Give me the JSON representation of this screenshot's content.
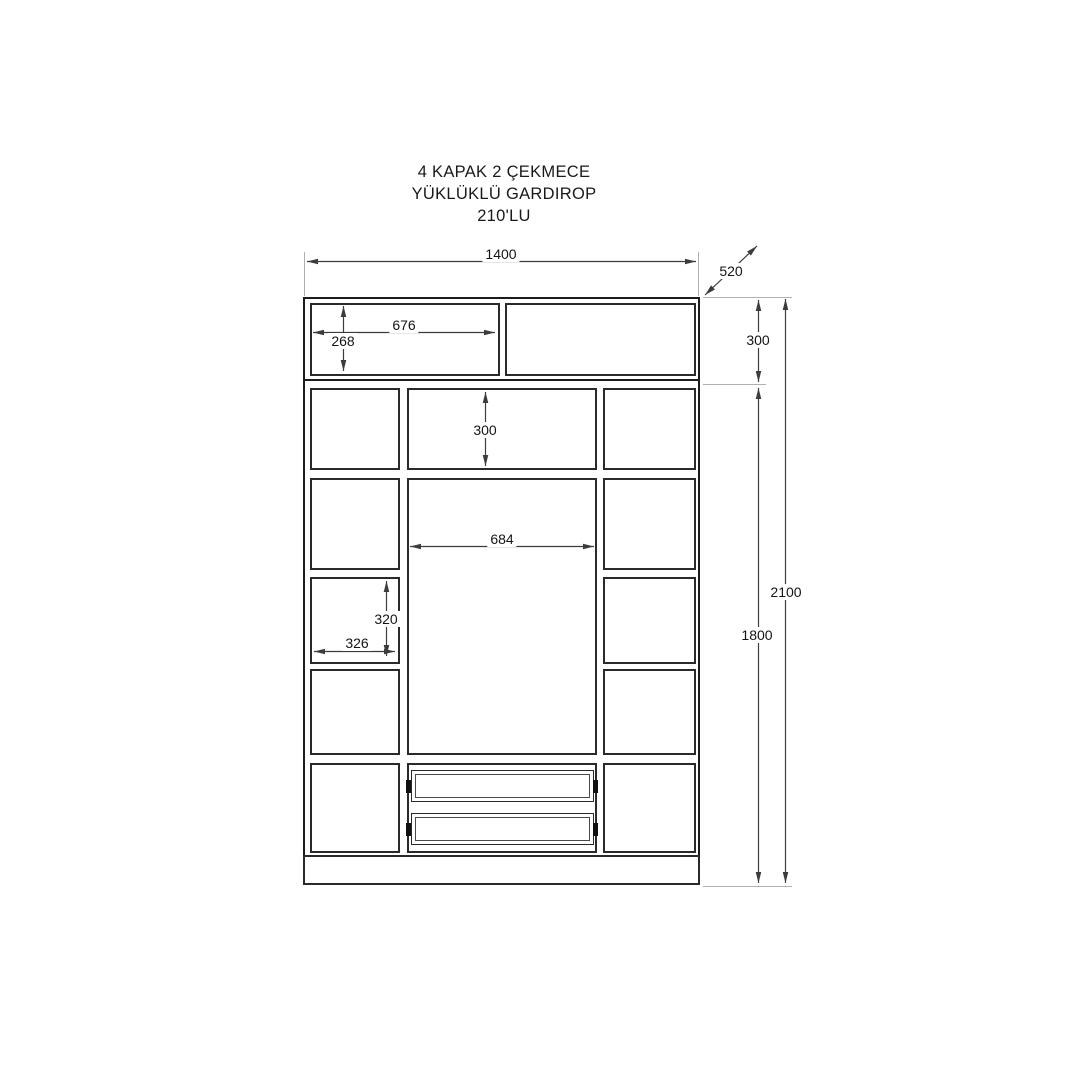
{
  "title": {
    "line1": "4 KAPAK 2 ÇEKMECE",
    "line2": "YÜKLÜKLÜ GARDIROP",
    "line3": "210'LU"
  },
  "dimensions": {
    "overall_width": "1400",
    "depth": "520",
    "top_section_height": "300",
    "total_height": "2100",
    "body_height": "1800",
    "top_door_width": "676",
    "top_door_height": "268",
    "upper_compartment_height": "300",
    "middle_opening_width": "684",
    "side_compartment_height": "320",
    "side_compartment_width": "326"
  },
  "colors": {
    "background": "#ffffff",
    "cabinet_line": "#1c1c1c",
    "dimension_line": "#3c3c3c",
    "extension_line": "#b0b0b0",
    "text": "#141414"
  }
}
